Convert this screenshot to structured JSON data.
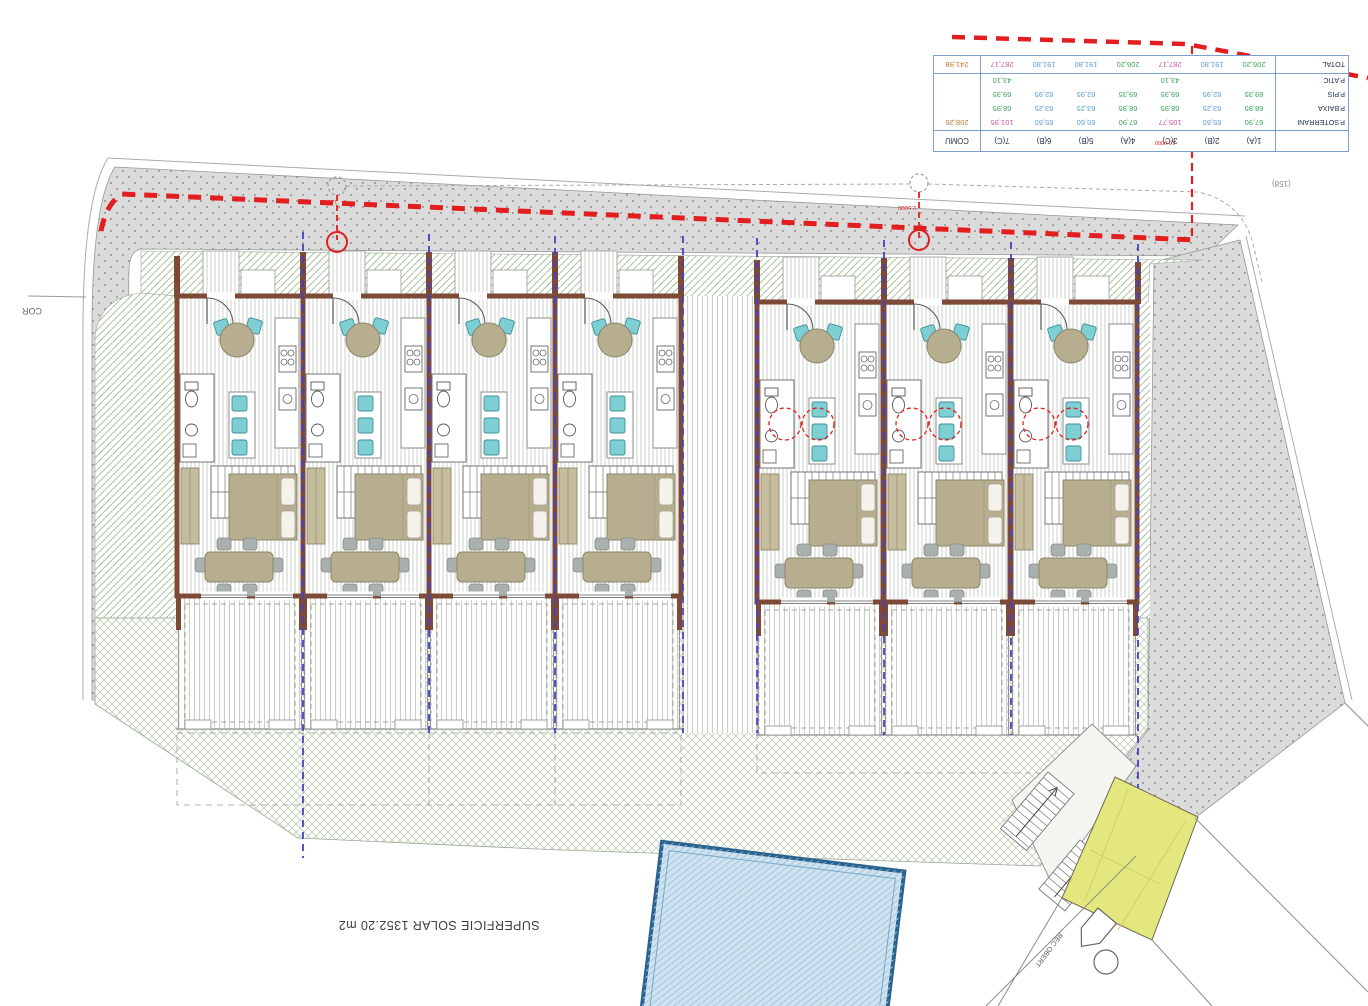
{
  "title": "Residential site plan — 7 row houses",
  "table": {
    "columns": [
      "1(A)",
      "2(B)",
      "3(C)",
      "4(A)",
      "5(B)",
      "6(B)",
      "7(C)",
      "COMU"
    ],
    "rows": [
      {
        "label": "P.SOTERRANI",
        "values": [
          "67,90",
          "65,60",
          "105,77",
          "67,90",
          "65,60",
          "65,60",
          "101,95",
          "208,26"
        ],
        "colors": [
          "g",
          "b",
          "m",
          "g",
          "b",
          "b",
          "m",
          "o"
        ]
      },
      {
        "label": "P.BAIXA",
        "values": [
          "68,95",
          "63,25",
          "68,95",
          "68,95",
          "63,25",
          "63,25",
          "68,95",
          ""
        ],
        "colors": [
          "g",
          "b",
          "g",
          "g",
          "b",
          "b",
          "g",
          ""
        ]
      },
      {
        "label": "P.PIS",
        "values": [
          "69,35",
          "62,95",
          "69,35",
          "69,35",
          "62,95",
          "62,95",
          "69,35",
          ""
        ],
        "colors": [
          "g",
          "b",
          "g",
          "g",
          "b",
          "b",
          "g",
          ""
        ]
      },
      {
        "label": "P.ATIC",
        "values": [
          "",
          "",
          "43,10",
          "",
          "",
          "",
          "43,10",
          ""
        ],
        "colors": [
          "",
          "",
          "g",
          "",
          "",
          "",
          "g",
          ""
        ]
      },
      {
        "label": "TOTAL",
        "values": [
          "206,20",
          "191,80",
          "287,17",
          "206,20",
          "191,80",
          "191,80",
          "287,17",
          "241,98"
        ],
        "colors": [
          "g",
          "b",
          "m",
          "g",
          "b",
          "b",
          "m",
          "o"
        ]
      }
    ]
  },
  "labels": {
    "superficie": "SUPERFICIE SOLAR  1352.20 m2",
    "cor": "COR",
    "ref158": "(158)",
    "dim_right": "2.5000",
    "dim_table": "10.0000",
    "dim_left": "1.0660",
    "rec_obert": "REC OBERT"
  },
  "colors": {
    "boundary_red": "#e31e1e",
    "party_wall_blue": "#4340cf",
    "wall_brown": "#7c4a36",
    "garden_hatch_green": "#9cba90",
    "garden_cross_green": "#b4c6ac",
    "furniture_tan": "#b7ae90",
    "chair_cyan": "#7ecfd4",
    "pool_border": "#2a628f",
    "pool_fill": "#cfe3f1",
    "ramp_yellow": "#e3e77e",
    "sidewalk_gray": "#dcdcdc",
    "table_border_blue": "#7ba0d0",
    "value_green": "#3da35a",
    "value_blue": "#5b9bd5",
    "value_magenta": "#c55aa0",
    "value_orange": "#c07a30"
  }
}
